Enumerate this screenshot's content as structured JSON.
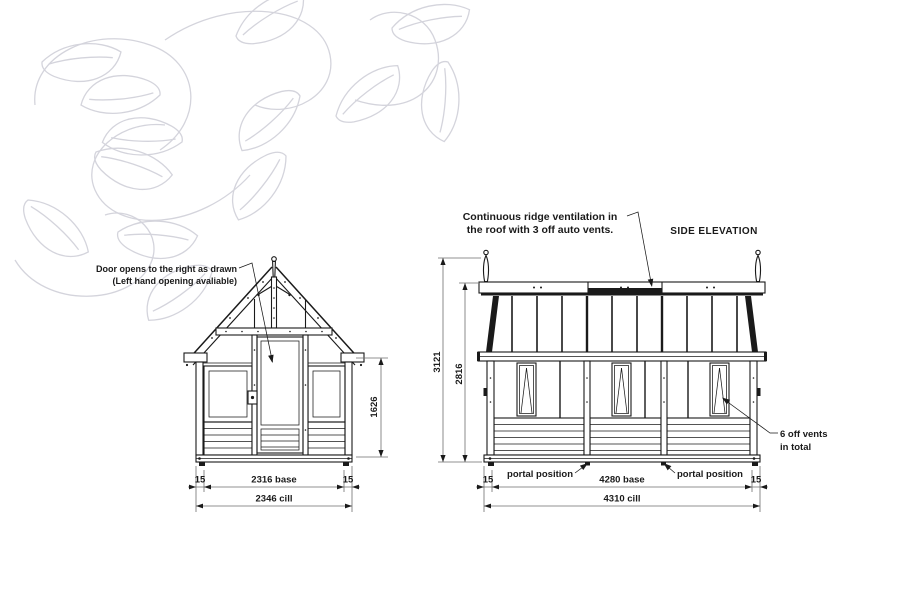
{
  "front": {
    "door_note_1": "Door opens to the right as drawn",
    "door_note_2": "(Left hand opening avaliable)",
    "height_dim": "1626",
    "margin_left": "15",
    "base_dim": "2316 base",
    "margin_right": "15",
    "cill_dim": "2346 cill"
  },
  "side": {
    "title": "SIDE ELEVATION",
    "ridge_note_1": "Continuous ridge ventilation in",
    "ridge_note_2": "the roof with 3 off auto vents.",
    "vents_note_1": "6 off vents",
    "vents_note_2": "in total",
    "overall_height_dim": "3121",
    "ridge_height_dim": "2816",
    "margin_left": "15",
    "base_dim": "4280 base",
    "margin_right": "15",
    "cill_dim": "4310 cill",
    "portal_label_left": "portal position",
    "portal_label_right": "portal position"
  },
  "colors": {
    "ink": "#1a1a1a",
    "dimension_lines": "#6e6e6e",
    "leaf_pattern": "#d4d4dc",
    "background": "#ffffff"
  }
}
